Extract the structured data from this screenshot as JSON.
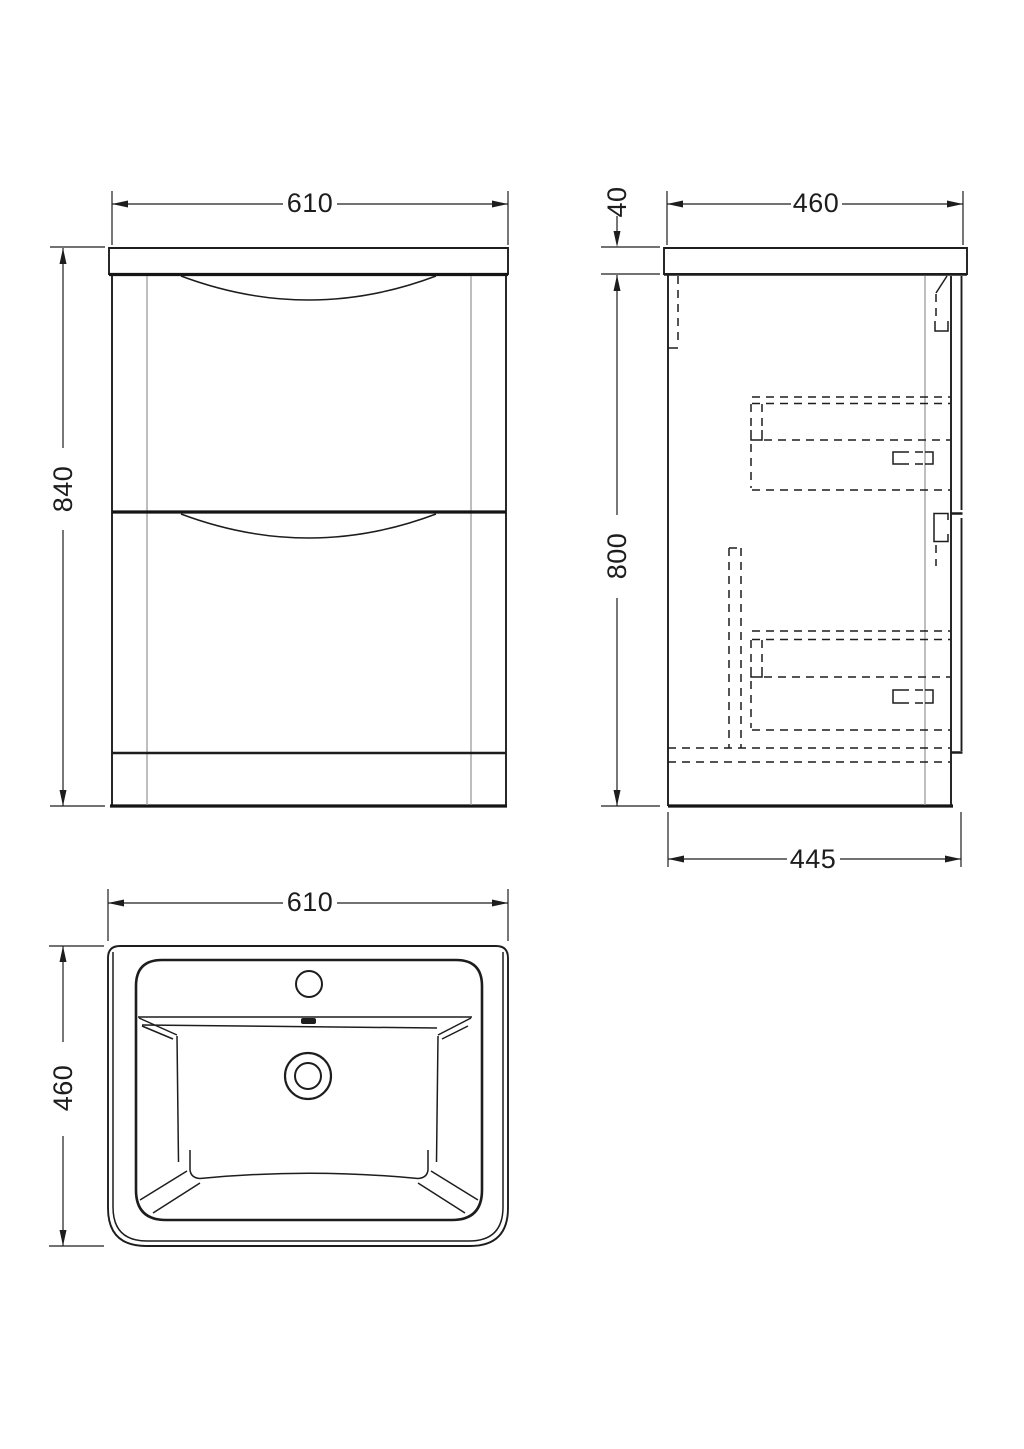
{
  "sheet": {
    "background": "#ffffff",
    "line_color": "#1d1d1d",
    "secondary_line_color": "#9b9b9b",
    "units": "mm"
  },
  "views": {
    "front_elevation": {
      "description": "vanity unit front view with two drawers",
      "width_label": "610",
      "height_label": "840"
    },
    "side_section": {
      "description": "vanity unit side view with hidden drawer boxes",
      "worktop_thickness_label": "40",
      "depth_label": "460",
      "carcass_height_label": "800",
      "carcass_depth_label": "445"
    },
    "basin_plan": {
      "description": "basin top view with tap hole, overflow and waste",
      "width_label": "610",
      "depth_label": "460"
    }
  }
}
